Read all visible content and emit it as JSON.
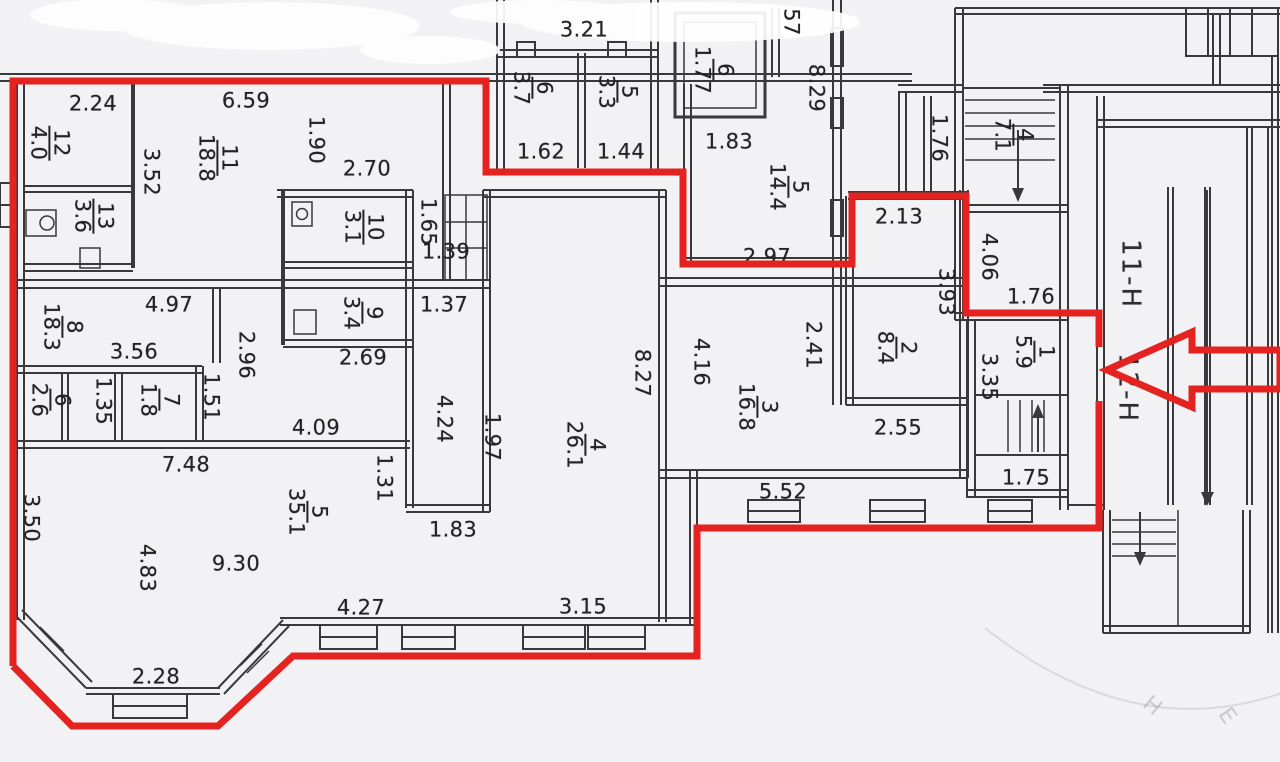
{
  "annotation": {
    "color": "#e42320",
    "stroke_width": 7,
    "outline": [
      [
        [
          13,
          666
        ],
        [
          13,
          81
        ],
        [
          486,
          81
        ],
        [
          486,
          172
        ],
        [
          683,
          172
        ],
        [
          683,
          264
        ],
        [
          852,
          264
        ],
        [
          852,
          196
        ],
        [
          966,
          196
        ],
        [
          966,
          313
        ],
        [
          1099,
          313
        ],
        [
          1099,
          347
        ]
      ],
      [
        [
          1099,
          401
        ],
        [
          1099,
          528
        ],
        [
          697,
          528
        ],
        [
          697,
          656
        ],
        [
          293,
          656
        ],
        [
          218,
          726
        ],
        [
          72,
          726
        ],
        [
          13,
          666
        ]
      ]
    ],
    "arrow": [
      [
        1107,
        370
      ],
      [
        1192,
        332
      ],
      [
        1192,
        350
      ],
      [
        1280,
        350
      ],
      [
        1280,
        389
      ],
      [
        1192,
        389
      ],
      [
        1192,
        407
      ]
    ]
  },
  "rooms": [
    {
      "num": "12",
      "area": "4.0",
      "x": 49,
      "y": 143
    },
    {
      "num": "11",
      "area": "18.8",
      "x": 217,
      "y": 158
    },
    {
      "num": "13",
      "area": "3.6",
      "x": 93,
      "y": 216
    },
    {
      "num": "10",
      "area": "3.1",
      "x": 363,
      "y": 227
    },
    {
      "num": "9",
      "area": "3.4",
      "x": 362,
      "y": 313
    },
    {
      "num": "8",
      "area": "18.3",
      "x": 62,
      "y": 327
    },
    {
      "num": "6",
      "area": "2.6",
      "x": 50,
      "y": 400
    },
    {
      "num": "7",
      "area": "1.8",
      "x": 159,
      "y": 400
    },
    {
      "num": "5",
      "area": "35.1",
      "x": 307,
      "y": 512
    },
    {
      "num": "4",
      "area": "26.1",
      "x": 585,
      "y": 445
    },
    {
      "num": "6",
      "area": "3.7",
      "x": 532,
      "y": 88
    },
    {
      "num": "5",
      "area": "3.3",
      "x": 617,
      "y": 92
    },
    {
      "num": "6",
      "area": "1.77",
      "x": 713,
      "y": 70
    },
    {
      "num": "5",
      "area": "14.4",
      "x": 788,
      "y": 187
    },
    {
      "num": "3",
      "area": "16.8",
      "x": 757,
      "y": 407
    },
    {
      "num": "2",
      "area": "8.4",
      "x": 896,
      "y": 348
    },
    {
      "num": "1",
      "area": "5.9",
      "x": 1034,
      "y": 352
    },
    {
      "num": "4",
      "area": "7.1",
      "x": 1013,
      "y": 135
    }
  ],
  "dims": [
    {
      "v": "2.24",
      "x": 93,
      "y": 104,
      "rot": 0
    },
    {
      "v": "6.59",
      "x": 246,
      "y": 101,
      "rot": 0
    },
    {
      "v": "1.90",
      "x": 316,
      "y": 140,
      "rot": 90
    },
    {
      "v": "2.70",
      "x": 367,
      "y": 169,
      "rot": 0
    },
    {
      "v": "3.52",
      "x": 151,
      "y": 172,
      "rot": 90
    },
    {
      "v": "1.65",
      "x": 428,
      "y": 222,
      "rot": 90
    },
    {
      "v": "1.39",
      "x": 446,
      "y": 252,
      "rot": 0
    },
    {
      "v": "1.37",
      "x": 444,
      "y": 305,
      "rot": 0
    },
    {
      "v": "4.97",
      "x": 169,
      "y": 305,
      "rot": 0
    },
    {
      "v": "3.56",
      "x": 134,
      "y": 352,
      "rot": 0
    },
    {
      "v": "2.96",
      "x": 246,
      "y": 355,
      "rot": 90
    },
    {
      "v": "1.51",
      "x": 211,
      "y": 397,
      "rot": 90
    },
    {
      "v": "1.35",
      "x": 103,
      "y": 401,
      "rot": 90
    },
    {
      "v": "2.69",
      "x": 363,
      "y": 358,
      "rot": 0
    },
    {
      "v": "4.09",
      "x": 316,
      "y": 428,
      "rot": 0
    },
    {
      "v": "7.48",
      "x": 186,
      "y": 465,
      "rot": 0
    },
    {
      "v": "3.50",
      "x": 31,
      "y": 518,
      "rot": 90
    },
    {
      "v": "4.83",
      "x": 147,
      "y": 568,
      "rot": 90
    },
    {
      "v": "9.30",
      "x": 236,
      "y": 564,
      "rot": 0
    },
    {
      "v": "2.28",
      "x": 156,
      "y": 677,
      "rot": 0
    },
    {
      "v": "4.27",
      "x": 361,
      "y": 608,
      "rot": 0
    },
    {
      "v": "3.15",
      "x": 583,
      "y": 607,
      "rot": 0
    },
    {
      "v": "1.83",
      "x": 453,
      "y": 530,
      "rot": 0
    },
    {
      "v": "1.31",
      "x": 384,
      "y": 478,
      "rot": 90
    },
    {
      "v": "1.97",
      "x": 492,
      "y": 437,
      "rot": 90
    },
    {
      "v": "4.24",
      "x": 444,
      "y": 419,
      "rot": 90
    },
    {
      "v": "8.27",
      "x": 642,
      "y": 373,
      "rot": 90
    },
    {
      "v": "3.21",
      "x": 584,
      "y": 30,
      "rot": 0
    },
    {
      "v": "1.62",
      "x": 541,
      "y": 152,
      "rot": 0
    },
    {
      "v": "1.44",
      "x": 621,
      "y": 152,
      "rot": 0
    },
    {
      "v": "1.83",
      "x": 729,
      "y": 142,
      "rot": 0
    },
    {
      "v": "2.97",
      "x": 767,
      "y": 257,
      "rot": 0
    },
    {
      "v": "57",
      "x": 791,
      "y": 22,
      "rot": 90
    },
    {
      "v": "8.29",
      "x": 816,
      "y": 88,
      "rot": 90
    },
    {
      "v": "4.16",
      "x": 701,
      "y": 362,
      "rot": 90
    },
    {
      "v": "2.41",
      "x": 813,
      "y": 345,
      "rot": 90
    },
    {
      "v": "5.52",
      "x": 783,
      "y": 492,
      "rot": 0
    },
    {
      "v": "2.55",
      "x": 898,
      "y": 428,
      "rot": 0
    },
    {
      "v": "2.13",
      "x": 899,
      "y": 217,
      "rot": 0
    },
    {
      "v": "3.93",
      "x": 946,
      "y": 292,
      "rot": 90
    },
    {
      "v": "4.06",
      "x": 989,
      "y": 257,
      "rot": 90
    },
    {
      "v": "1.76",
      "x": 1031,
      "y": 297,
      "rot": 0
    },
    {
      "v": "3.35",
      "x": 989,
      "y": 377,
      "rot": 90
    },
    {
      "v": "1.75",
      "x": 1026,
      "y": 478,
      "rot": 0
    },
    {
      "v": "1.76",
      "x": 939,
      "y": 138,
      "rot": 90
    }
  ],
  "zones": [
    {
      "text": "11-Н",
      "x": 1130,
      "y": 274
    },
    {
      "text": "12-Н",
      "x": 1127,
      "y": 388
    }
  ],
  "stamp": {
    "letters": [
      {
        "ch": "Н",
        "x": 1152,
        "y": 706,
        "rot": 40
      },
      {
        "ch": "Е",
        "x": 1227,
        "y": 716,
        "rot": 55
      }
    ]
  }
}
